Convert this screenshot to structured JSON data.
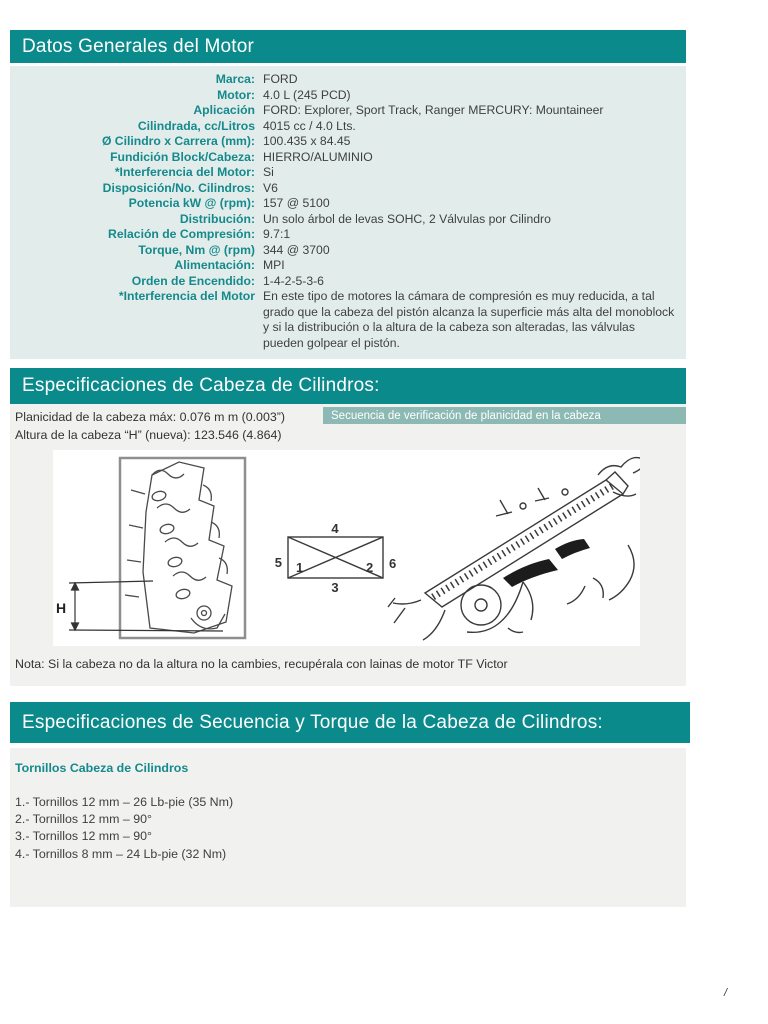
{
  "colors": {
    "teal": "#0b8a8c",
    "teal_text": "#15898c",
    "panel_green": "#e2edeb",
    "panel_gray": "#f1f1f0",
    "subbar": "#8db9b5"
  },
  "section1": {
    "title": "Datos Generales del Motor",
    "rows": [
      {
        "label": "Marca:",
        "value": "FORD"
      },
      {
        "label": "Motor:",
        "value": "4.0 L (245 PCD)"
      },
      {
        "label": "Aplicación",
        "value": "FORD: Explorer, Sport Track, Ranger MERCURY: Mountaineer"
      },
      {
        "label": "Cilindrada, cc/Litros",
        "value": "4015 cc / 4.0 Lts."
      },
      {
        "label": "Ø Cilindro x Carrera (mm):",
        "value": "100.435 x 84.45"
      },
      {
        "label": "Fundición Block/Cabeza:",
        "value": "HIERRO/ALUMINIO"
      },
      {
        "label": "*Interferencia del Motor:",
        "value": "Si"
      },
      {
        "label": "Disposición/No. Cilindros:",
        "value": "V6"
      },
      {
        "label": "Potencia kW @ (rpm):",
        "value": "157 @ 5100"
      },
      {
        "label": "Distribución:",
        "value": "Un solo árbol de levas SOHC, 2 Válvulas por Cilindro"
      },
      {
        "label": "Relación de Compresión:",
        "value": "9.7:1"
      },
      {
        "label": "Torque, Nm @ (rpm)",
        "value": "344 @ 3700"
      },
      {
        "label": "Alimentación:",
        "value": "MPI"
      },
      {
        "label": "Orden de Encendido:",
        "value": "1-4-2-5-3-6"
      },
      {
        "label": "*Interferencia del Motor",
        "value": "En este tipo de motores la cámara de compresión es muy reducida, a tal grado que la cabeza del pistón alcanza la superficie más alta del monoblock y si la distribución o la altura de la cabeza son alteradas, las válvulas pueden golpear el pistón."
      }
    ]
  },
  "section2": {
    "title": "Especificaciones de Cabeza de Cilindros:",
    "flatness_line": "Planicidad de la cabeza máx: 0.076 m m (0.003”)",
    "height_line": "Altura de la cabeza “H” (nueva): 123.546 (4.864)",
    "subbar_label": "Secuencia de verificación de planicidad en la cabeza",
    "figure": {
      "h_label": "H",
      "sequence_labels": {
        "top": "4",
        "left": "5",
        "inner_left": "1",
        "inner_right": "2",
        "right": "6",
        "bottom": "3"
      }
    },
    "note": "Nota: Si la cabeza no da la altura no la cambies, recupérala con lainas de motor TF Victor"
  },
  "section3": {
    "title": "Especificaciones de Secuencia y Torque de la Cabeza de Cilindros:",
    "subtitle": "Tornillos Cabeza de Cilindros",
    "items": [
      "1.- Tornillos 12 mm – 26 Lb-pie (35 Nm)",
      "2.- Tornillos 12 mm – 90°",
      "3.- Tornillos 12 mm – 90°",
      "4.- Tornillos 8 mm – 24 Lb-pie (32 Nm)"
    ]
  },
  "page": {
    "indicator": "/"
  }
}
